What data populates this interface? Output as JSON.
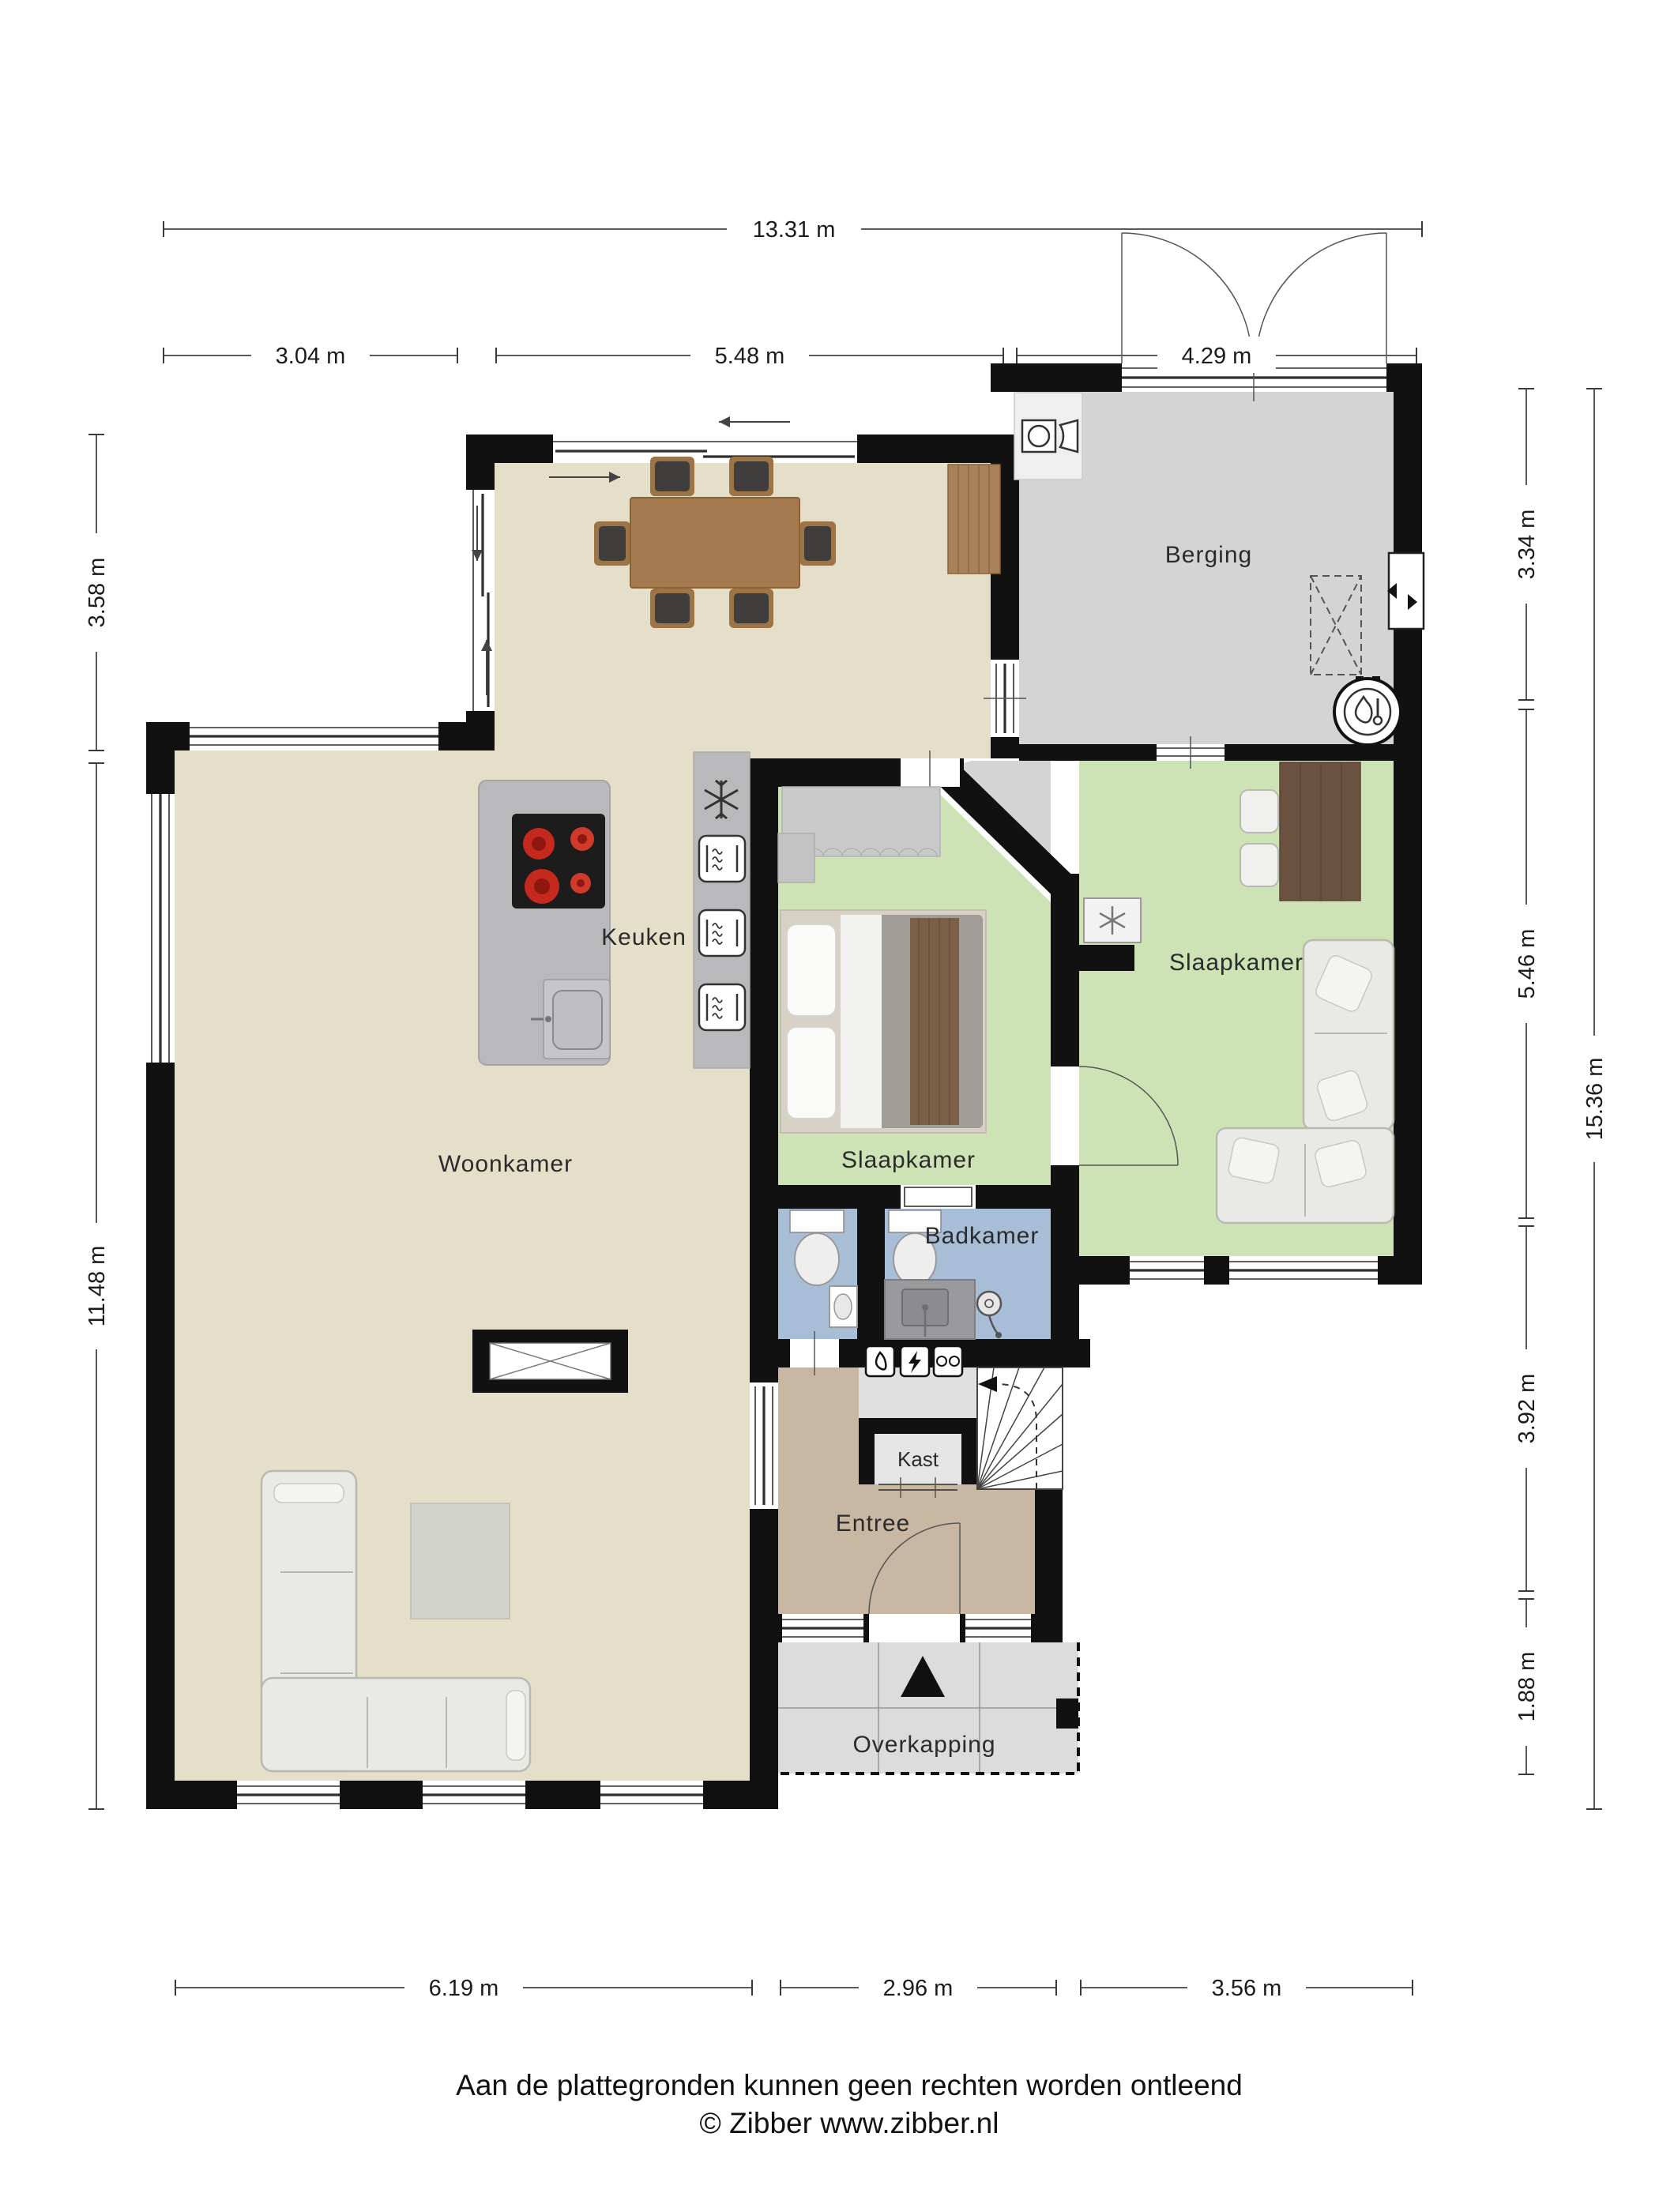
{
  "plan": {
    "type": "floorplan",
    "floor": "ground floor",
    "rooms": {
      "berging": {
        "label": "Berging"
      },
      "keuken": {
        "label": "Keuken"
      },
      "woonkamer": {
        "label": "Woonkamer"
      },
      "slaapkamer_middle": {
        "label": "Slaapkamer"
      },
      "slaapkamer_right": {
        "label": "Slaapkamer"
      },
      "badkamer": {
        "label": "Badkamer"
      },
      "kast": {
        "label": "Kast"
      },
      "entree": {
        "label": "Entree"
      },
      "overkapping": {
        "label": "Overkapping"
      }
    },
    "dimensions": {
      "top_total": {
        "label": "13.31 m"
      },
      "top_segments": [
        {
          "label": "3.04 m"
        },
        {
          "label": "5.48 m"
        },
        {
          "label": "4.29 m"
        }
      ],
      "left_segments": [
        {
          "label": "3.58 m"
        },
        {
          "label": "11.48 m"
        }
      ],
      "right_segments": [
        {
          "label": "3.34 m"
        },
        {
          "label": "5.46 m"
        },
        {
          "label": "3.92 m"
        },
        {
          "label": "1.88 m"
        }
      ],
      "right_total": {
        "label": "15.36 m"
      },
      "bottom_segments": [
        {
          "label": "6.19 m"
        },
        {
          "label": "2.96 m"
        },
        {
          "label": "3.56 m"
        }
      ]
    },
    "colors": {
      "wall": "#111111",
      "floor_living": "#e5dfca",
      "floor_bedroom": "#cee3b5",
      "floor_storage": "#d4d4d4",
      "floor_bath": "#a8bed7",
      "floor_entry": "#c8b7a3",
      "floor_canopy": "#dcdcdc",
      "counter": "#b9b9bc",
      "wood": "#a57a4e",
      "wood_dark": "#6b5140",
      "sofa": "#e9e9e6"
    },
    "footer": {
      "line1": "Aan de plattegronden kunnen geen rechten worden ontleend",
      "line2": "© Zibber www.zibber.nl"
    }
  }
}
